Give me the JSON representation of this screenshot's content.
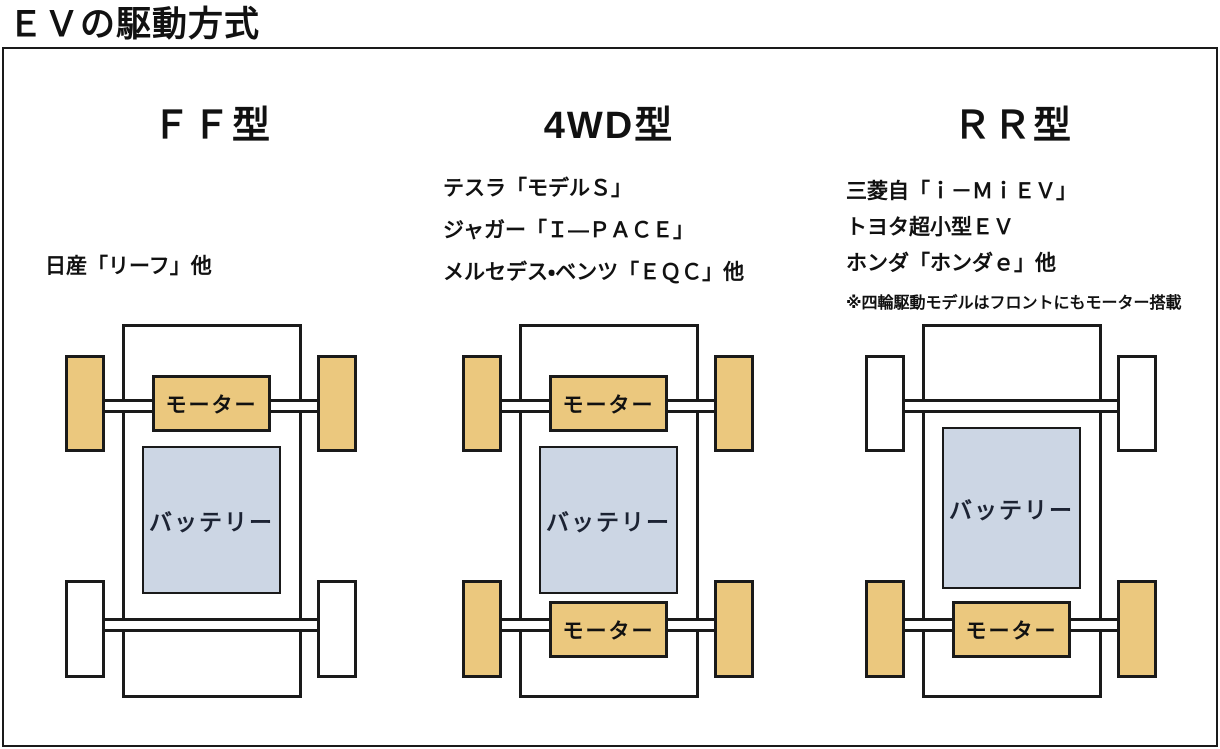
{
  "page_title": "ＥＶの駆動方式",
  "labels": {
    "motor": "モーター",
    "battery": "バッテリー"
  },
  "colors": {
    "driven_wheel": "#ebc87e",
    "free_wheel": "#ffffff",
    "motor_box": "#ebc87e",
    "battery_box": "#ccd6e4",
    "outline": "#1a1a1a",
    "text": "#111111"
  },
  "columns": [
    {
      "title": "ＦＦ型",
      "models": [
        "日産「リーフ」他"
      ],
      "note": "",
      "drive_layout": {
        "motors": [
          "front"
        ],
        "driven_wheels": [
          "front"
        ]
      }
    },
    {
      "title": "4WD型",
      "models": [
        "テスラ「モデルＳ」",
        "ジャガー「Ｉ―ＰＡＣＥ」",
        "メルセデス・ベンツ「ＥＱＣ」他"
      ],
      "note": "",
      "drive_layout": {
        "motors": [
          "front",
          "rear"
        ],
        "driven_wheels": [
          "front",
          "rear"
        ]
      }
    },
    {
      "title": "ＲＲ型",
      "models": [
        "三菱自「ｉ－ＭｉＥＶ」",
        "トヨタ超小型ＥＶ",
        "ホンダ「ホンダｅ」他"
      ],
      "note": "※四輪駆動モデルはフロントにもモーター搭載",
      "drive_layout": {
        "motors": [
          "rear"
        ],
        "driven_wheels": [
          "rear"
        ]
      }
    }
  ]
}
